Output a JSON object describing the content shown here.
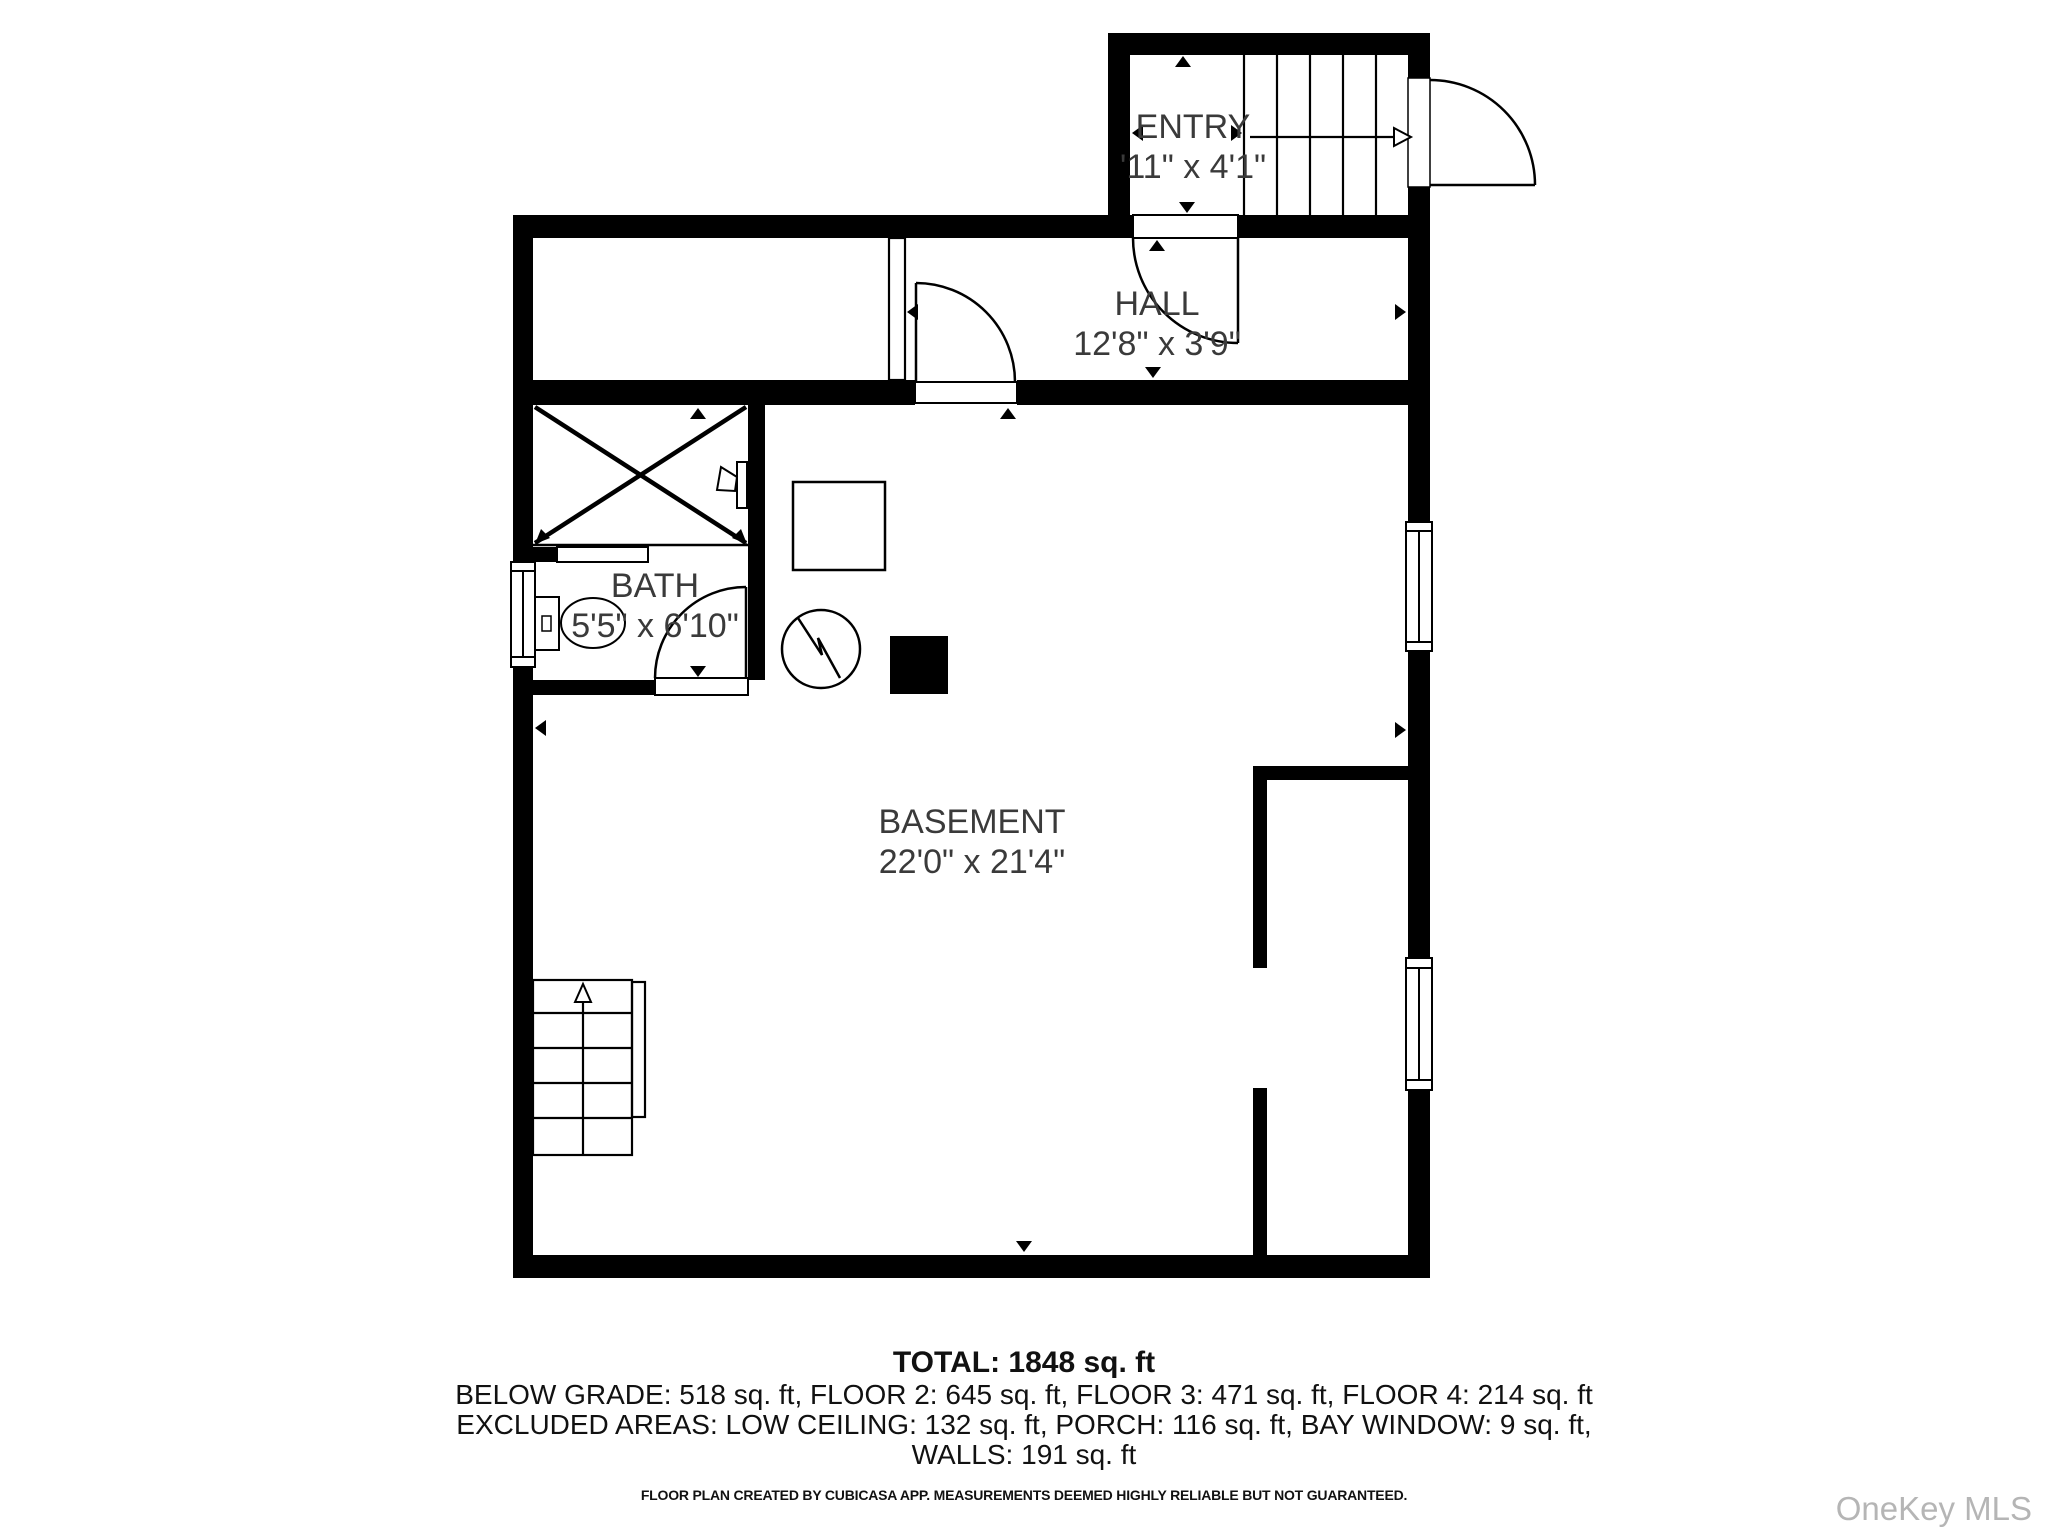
{
  "colors": {
    "wall": "#000000",
    "background": "#ffffff",
    "label_text": "#3a3a3a",
    "footer_text": "#111111",
    "watermark_text": "#b5b5b5"
  },
  "rooms": [
    {
      "id": "entry",
      "name": "ENTRY",
      "dimensions": "'11\" x 4'1\""
    },
    {
      "id": "hall",
      "name": "HALL",
      "dimensions": "12'8\" x 3'9\""
    },
    {
      "id": "bath",
      "name": "BATH",
      "dimensions": "5'5\" x 6'10\""
    },
    {
      "id": "basement",
      "name": "BASEMENT",
      "dimensions": "22'0\" x 21'4\""
    }
  ],
  "summary": {
    "total_line": "TOTAL: 1848 sq. ft",
    "floors_line": "BELOW GRADE: 518 sq. ft, FLOOR 2: 645 sq. ft, FLOOR 3: 471 sq. ft, FLOOR 4: 214 sq. ft",
    "excluded_line": "EXCLUDED AREAS: LOW CEILING: 132 sq. ft, PORCH: 116 sq. ft, BAY WINDOW: 9 sq. ft,",
    "walls_line": "WALLS: 191 sq. ft",
    "areas": {
      "total_sqft": 1848,
      "below_grade_sqft": 518,
      "floor_2_sqft": 645,
      "floor_3_sqft": 471,
      "floor_4_sqft": 214,
      "excluded_low_ceiling_sqft": 132,
      "excluded_porch_sqft": 116,
      "excluded_bay_window_sqft": 9,
      "excluded_walls_sqft": 191
    }
  },
  "footer": {
    "disclaimer": "FLOOR PLAN CREATED BY CUBICASA APP. MEASUREMENTS DEEMED HIGHLY RELIABLE BUT NOT GUARANTEED."
  },
  "watermark": "OneKey MLS"
}
